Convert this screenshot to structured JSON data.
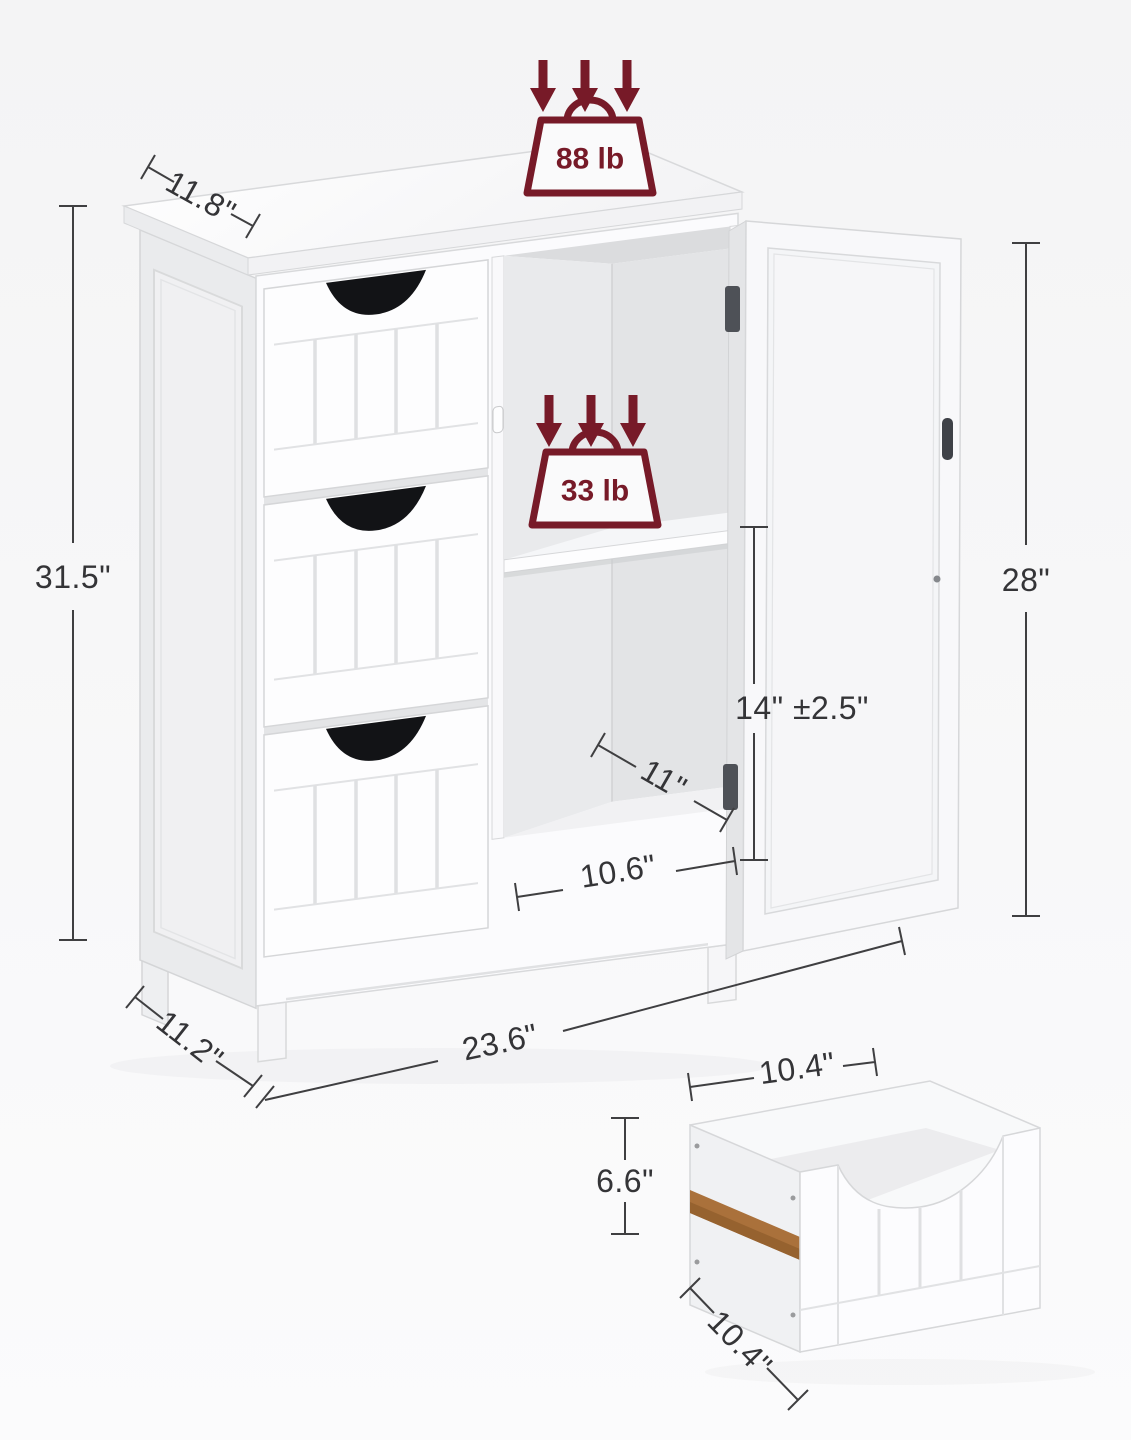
{
  "figure": {
    "type": "product-dimension-diagram",
    "subject": "white floor storage cabinet with 3 drawers and open shelf door",
    "background_color": "#f5f5f6",
    "accent_color": "#771a28",
    "dimension_line_color": "#3f3f41",
    "dimension_text_color": "#343437"
  },
  "load_capacity": {
    "top": "88 lb",
    "shelf": "33 lb"
  },
  "dimensions": {
    "top_depth": "11.8\"",
    "overall_height": "31.5\"",
    "door_height": "28\"",
    "shelf_adjustable_height": "14\" ±2.5\"",
    "interior_depth": "11\"",
    "opening_width": "10.6\"",
    "overall_width": "23.6\"",
    "base_depth": "11.2\"",
    "drawer_width": "10.4\"",
    "drawer_height": "6.6\"",
    "drawer_depth": "10.4\""
  }
}
